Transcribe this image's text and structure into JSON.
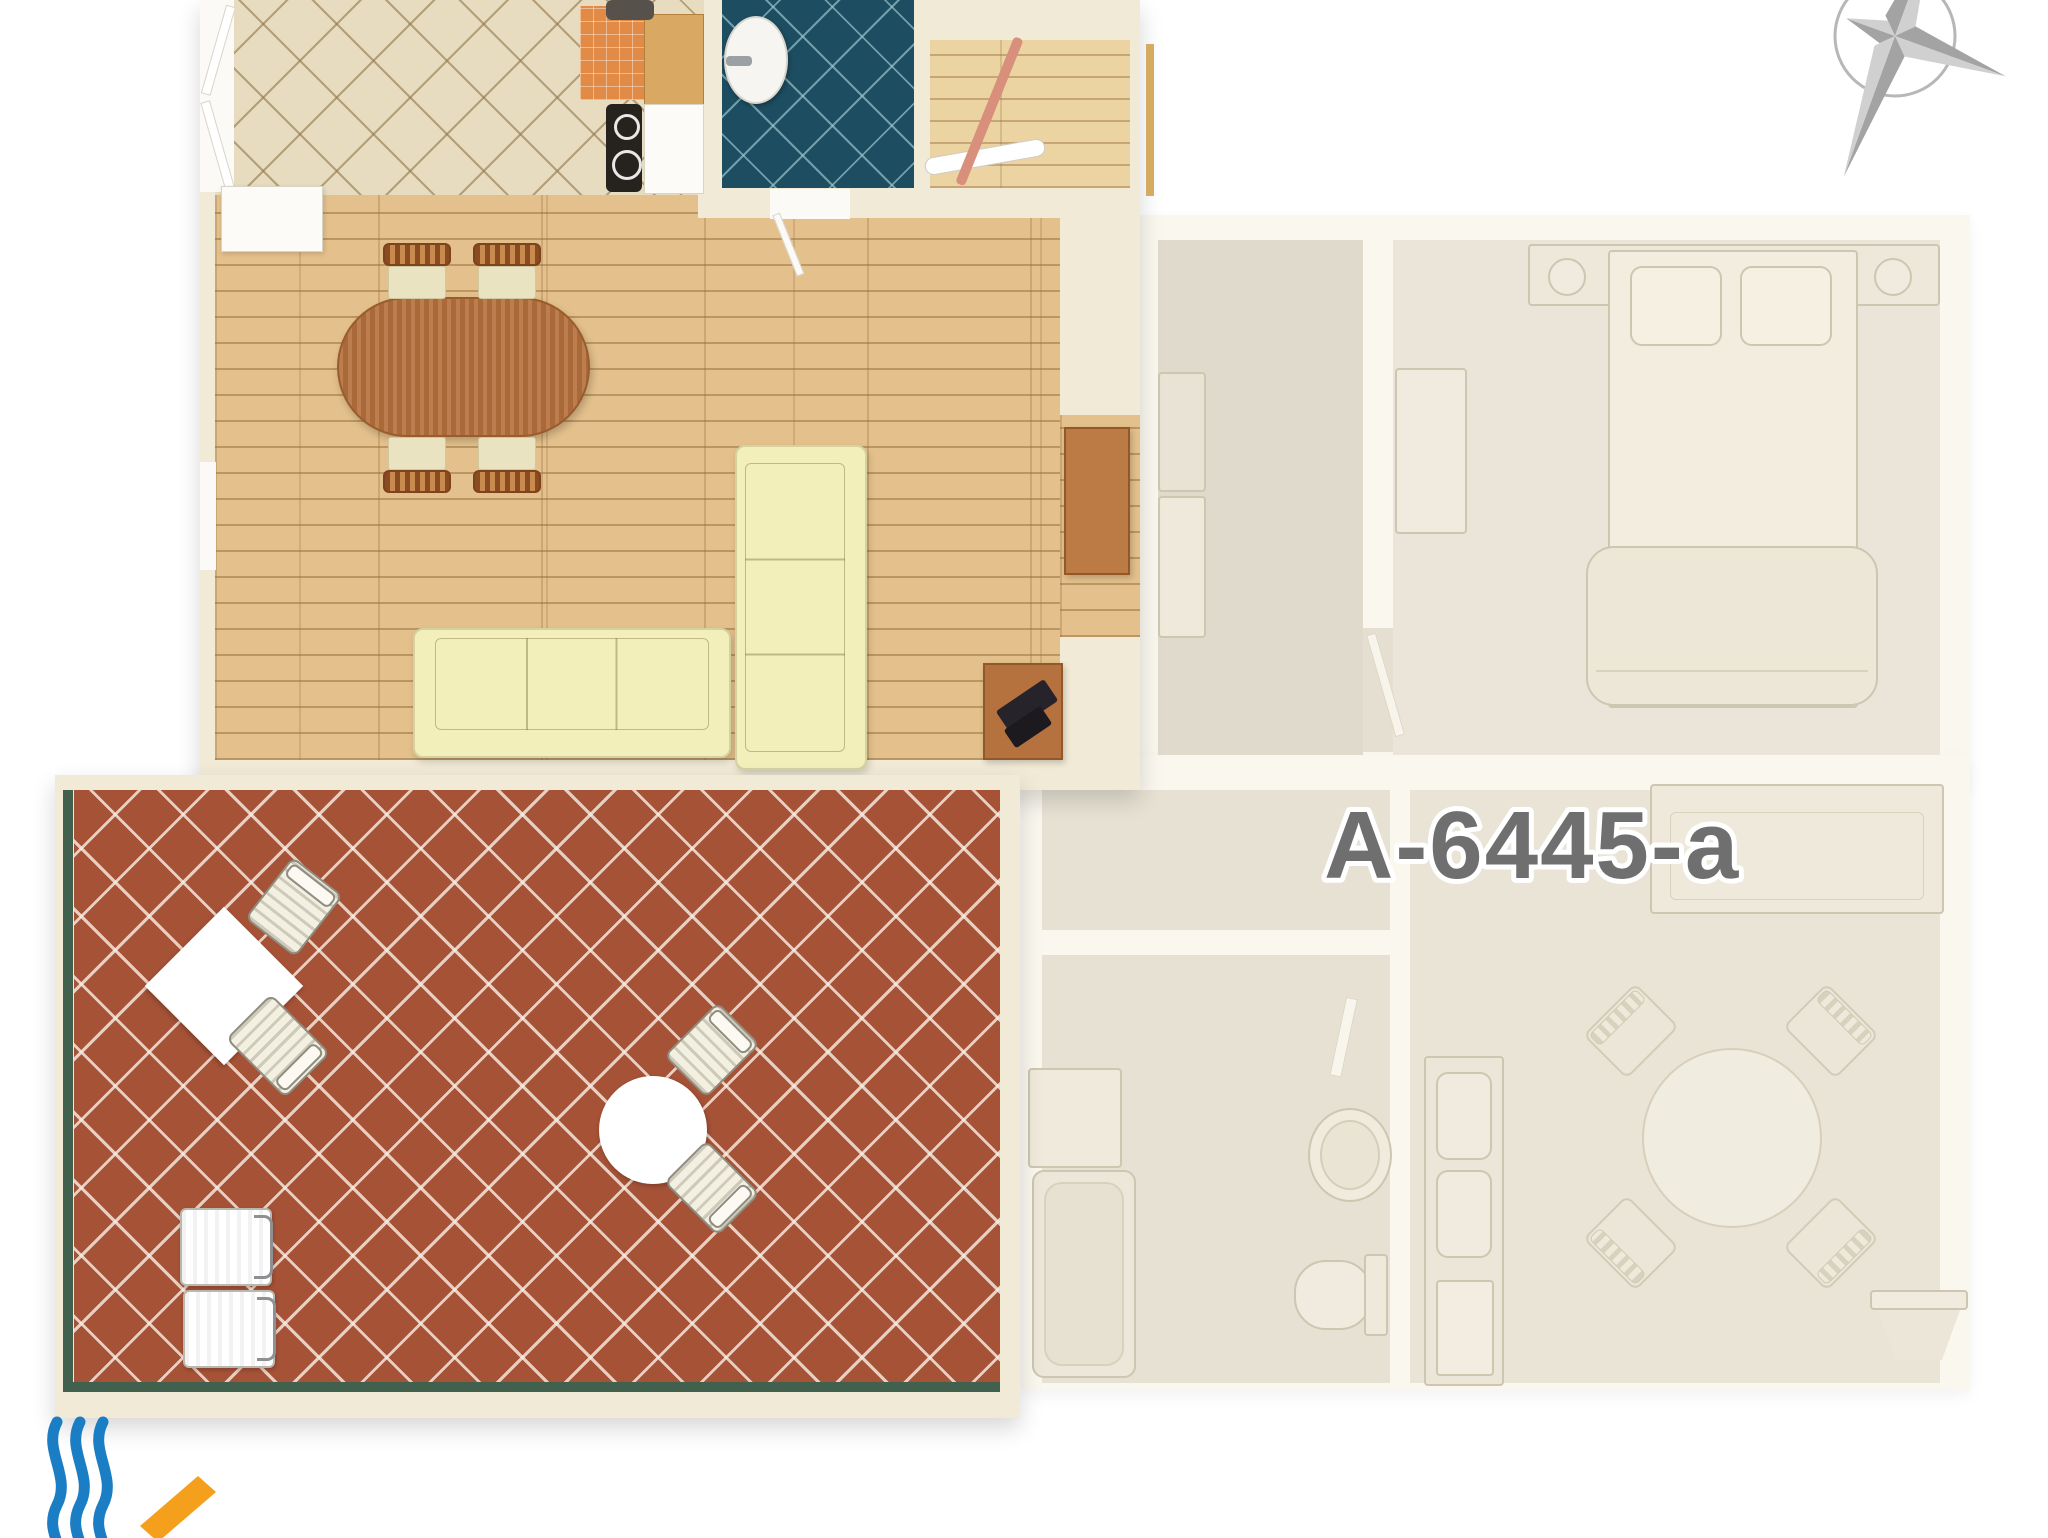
{
  "unit_label": "A-6445-a",
  "palette": {
    "wall_cream": "#f1ead6",
    "kitchen_tile": "#e7dcbf",
    "bath_tile": "#1d4d60",
    "wood": "#e4c18c",
    "utility_wood": "#ecd3a2",
    "terrace_tile": "#a55237",
    "rail_green": "#41604d",
    "counter_orange": "#e18b47",
    "counter_wood": "#d9a963",
    "cooktop_black": "#26221e",
    "sofa_yellow": "#f3efbb",
    "table_wood": "#b5713e",
    "chair_back": "#a25c2e",
    "chair_seat": "#e9e3c2",
    "faded_wall": "#faf7ef",
    "faded_floor": "#e6e1d3",
    "faded_fill": "#f0ebde",
    "faded_line": "#cdc6b1",
    "label_gray": "#6f6f6f",
    "compass_dark": "#a3a3a3",
    "compass_light": "#d0d0d0",
    "logo_blue": "#1b7ec5",
    "logo_orange": "#f5a01d"
  },
  "icons": {
    "compass": "compass-rose",
    "logo_waves": "sea-waves",
    "logo_stripe": "orange-stripe"
  }
}
